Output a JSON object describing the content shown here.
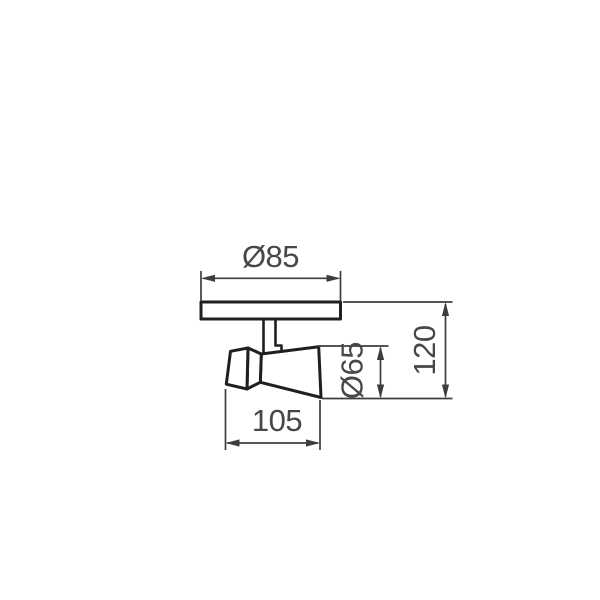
{
  "page": {
    "background": "#ffffff"
  },
  "colors": {
    "outline": "#1f1f1f",
    "dimension": "#3d3d3d",
    "label": "#474747",
    "background": "#ffffff"
  },
  "drawing": {
    "type": "technical-dimension-drawing",
    "subject": "wall-mount spotlight, side view with mounting plate, stem and cone-shaped lamp head",
    "dimensions": [
      {
        "id": "plate-diameter",
        "label": "Ø85",
        "orientation": "horizontal"
      },
      {
        "id": "overall-height",
        "label": "120",
        "orientation": "vertical"
      },
      {
        "id": "shade-diameter",
        "label": "Ø65",
        "orientation": "vertical"
      },
      {
        "id": "head-length",
        "label": "105",
        "orientation": "horizontal"
      }
    ]
  }
}
